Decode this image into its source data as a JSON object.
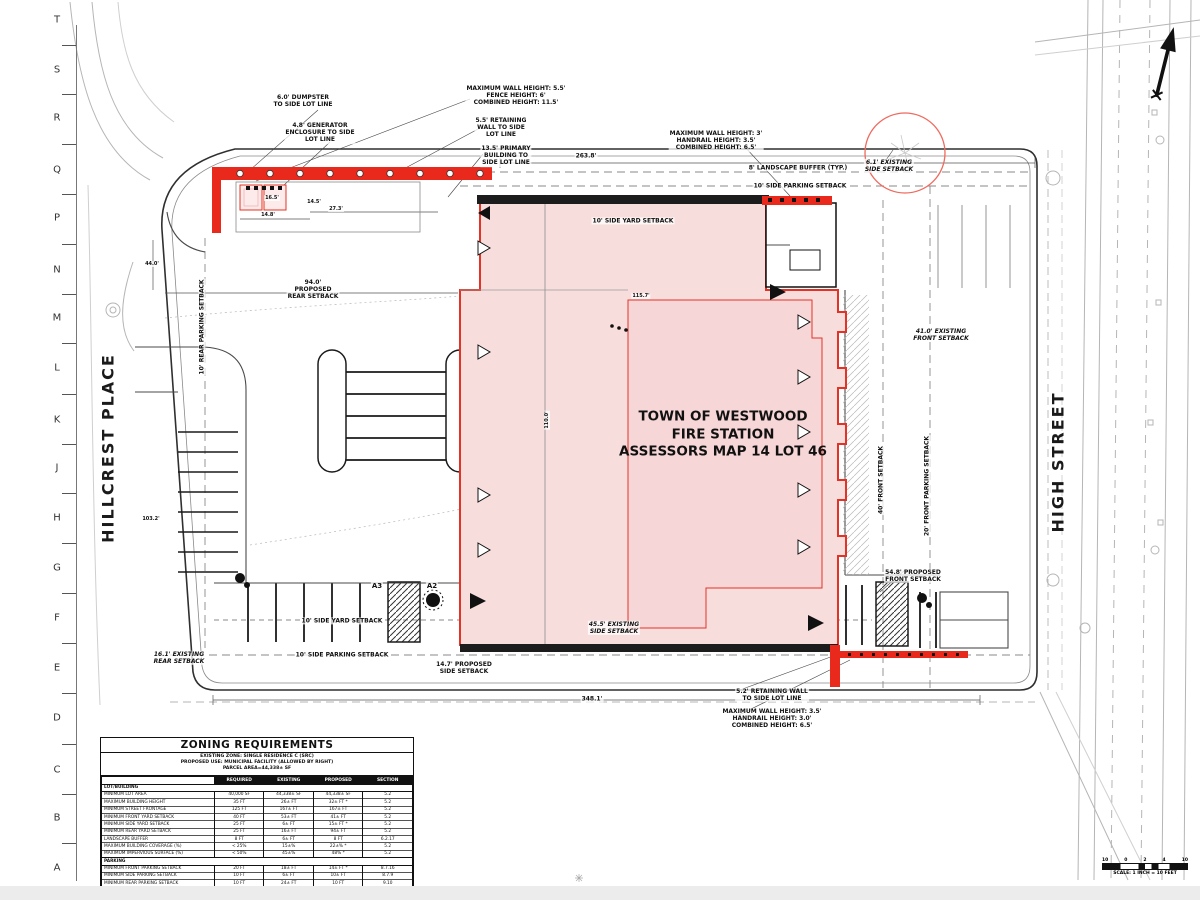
{
  "colors": {
    "accent_red": "#e43326",
    "pink_fill": "#f8dddd",
    "wall_black": "#1c1c1c"
  },
  "ruler": {
    "letters": [
      "T",
      "S",
      "R",
      "Q",
      "P",
      "N",
      "M",
      "L",
      "K",
      "J",
      "H",
      "G",
      "F",
      "E",
      "D",
      "C",
      "B",
      "A"
    ]
  },
  "streets": {
    "left": "HILLCREST PLACE",
    "right": "HIGH STREET"
  },
  "building": {
    "line1": "TOWN OF WESTWOOD",
    "line2": "FIRE STATION",
    "line3": "ASSESSORS MAP 14 LOT 46"
  },
  "annotations": [
    {
      "t": "6.0' DUMPSTER\nTO SIDE LOT LINE",
      "x": 303,
      "y": 101
    },
    {
      "t": "4.8' GENERATOR\nENCLOSURE TO SIDE\nLOT LINE",
      "x": 320,
      "y": 133
    },
    {
      "t": "MAXIMUM WALL HEIGHT: 5.5'\nFENCE HEIGHT: 6'\nCOMBINED HEIGHT: 11.5'",
      "x": 516,
      "y": 96
    },
    {
      "t": "5.5' RETAINING\nWALL TO SIDE\nLOT LINE",
      "x": 501,
      "y": 128
    },
    {
      "t": "13.5' PRIMARY\nBUILDING TO\nSIDE LOT LINE",
      "x": 506,
      "y": 156
    },
    {
      "t": "263.8'",
      "x": 586,
      "y": 156
    },
    {
      "t": "MAXIMUM WALL HEIGHT: 3'\nHANDRAIL HEIGHT: 3.5'\nCOMBINED HEIGHT: 6.5'",
      "x": 716,
      "y": 141
    },
    {
      "t": "8' LANDSCAPE BUFFER (TYP.)",
      "x": 798,
      "y": 168
    },
    {
      "t": "10' SIDE PARKING SETBACK",
      "x": 800,
      "y": 186
    },
    {
      "t": "6.1' EXISTING\nSIDE SETBACK",
      "x": 889,
      "y": 166,
      "i": true
    },
    {
      "t": "10' SIDE YARD SETBACK",
      "x": 633,
      "y": 221
    },
    {
      "t": "16.5'",
      "x": 272,
      "y": 198,
      "s": 5
    },
    {
      "t": "14.5'",
      "x": 314,
      "y": 202,
      "s": 5
    },
    {
      "t": "27.3'",
      "x": 336,
      "y": 209,
      "s": 5
    },
    {
      "t": "14.8'",
      "x": 268,
      "y": 215,
      "s": 5
    },
    {
      "t": "44.0'",
      "x": 152,
      "y": 264,
      "s": 5
    },
    {
      "t": "94.0'\nPROPOSED\nREAR SETBACK",
      "x": 313,
      "y": 290
    },
    {
      "t": "10' REAR PARKING SETBACK",
      "x": 202,
      "y": 327,
      "r": true
    },
    {
      "t": "115.7'",
      "x": 641,
      "y": 296,
      "s": 5
    },
    {
      "t": "110.0'",
      "x": 547,
      "y": 420,
      "r": true,
      "s": 5
    },
    {
      "t": "103.2'",
      "x": 151,
      "y": 519,
      "s": 5
    },
    {
      "t": "40' FRONT SETBACK",
      "x": 881,
      "y": 480,
      "r": true
    },
    {
      "t": "20' FRONT PARKING SETBACK",
      "x": 927,
      "y": 486,
      "r": true
    },
    {
      "t": "41.0' EXISTING\nFRONT SETBACK",
      "x": 941,
      "y": 335,
      "i": true
    },
    {
      "t": "A3",
      "x": 377,
      "y": 586,
      "s": 7
    },
    {
      "t": "A2",
      "x": 432,
      "y": 586,
      "s": 7
    },
    {
      "t": "10' SIDE YARD SETBACK",
      "x": 342,
      "y": 621
    },
    {
      "t": "45.5' EXISTING\nSIDE SETBACK",
      "x": 614,
      "y": 628,
      "i": true
    },
    {
      "t": "10' SIDE PARKING SETBACK",
      "x": 342,
      "y": 655
    },
    {
      "t": "16.1' EXISTING\nREAR SETBACK",
      "x": 179,
      "y": 658,
      "i": true
    },
    {
      "t": "14.7' PROPOSED\nSIDE SETBACK",
      "x": 464,
      "y": 668
    },
    {
      "t": "348.1'",
      "x": 592,
      "y": 699
    },
    {
      "t": "54.8' PROPOSED\nFRONT SETBACK",
      "x": 913,
      "y": 576
    },
    {
      "t": "5.2' RETAINING WALL\nTO SIDE LOT LINE",
      "x": 772,
      "y": 695
    },
    {
      "t": "MAXIMUM WALL HEIGHT: 3.5'\nHANDRAIL HEIGHT: 3.0'\nCOMBINED HEIGHT: 6.5'",
      "x": 772,
      "y": 719
    }
  ],
  "zoning_table": {
    "title": "ZONING REQUIREMENTS",
    "subtitle_lines": [
      "EXISTING ZONE: SINGLE RESIDENCE C (SRC)",
      "PROPOSED USE: MUNICIPAL FACILITY (ALLOWED BY RIGHT)",
      "PARCEL AREA=44,338± SF"
    ],
    "columns": [
      "",
      "REQUIRED",
      "EXISTING",
      "PROPOSED",
      "SECTION"
    ],
    "sections": [
      {
        "header": "LOT/BUILDING",
        "rows": [
          [
            "MINIMUM LOT AREA",
            "40,000 SF",
            "44,338± SF",
            "44,338± SF",
            "5.2"
          ],
          [
            "MAXIMUM BUILDING HEIGHT",
            "35 FT",
            "26± FT",
            "32± FT *",
            "5.2"
          ],
          [
            "MINIMUM STREET FRONTAGE",
            "125 FT",
            "167± FT",
            "167± FT",
            "5.2"
          ],
          [
            "MINIMUM FRONT YARD SETBACK",
            "40 FT",
            "53± FT",
            "41± FT",
            "5.2"
          ],
          [
            "MINIMUM SIDE YARD SETBACK",
            "25 FT",
            "6± FT",
            "15± FT *",
            "5.2"
          ],
          [
            "MINIMUM REAR YARD SETBACK",
            "25 FT",
            "16± FT",
            "94± FT",
            "5.2"
          ],
          [
            "LANDSCAPE BUFFER",
            "8 FT",
            "6± FT",
            "8 FT",
            "6.2.17"
          ],
          [
            "MAXIMUM BUILDING COVERAGE (%)",
            "< 25%",
            "15±%",
            "22±% *",
            "5.2"
          ],
          [
            "MAXIMUM IMPERVIOUS SURFACE (%)",
            "< 50%",
            "45±%",
            "48% *",
            "5.2"
          ]
        ]
      },
      {
        "header": "PARKING",
        "rows": [
          [
            "MINIMUM FRONT PARKING SETBACK",
            "20 FT",
            "18± FT",
            "14± FT *",
            "8.7.16"
          ],
          [
            "MINIMUM SIDE PARKING SETBACK",
            "10 FT",
            "6± FT",
            "10± FT",
            "8.7.9"
          ],
          [
            "MINIMUM REAR PARKING SETBACK",
            "10 FT",
            "24± FT",
            "10 FT",
            "9.10"
          ],
          [
            "MUNICIPAL FACILITIES",
            "N/A",
            "17",
            "38",
            "8.1.5.8"
          ],
          [
            "ADA STANDARD SPACES\nSTAFF LOT 1-25 SPACES\nPUBLIC LOT 1-25 SPACES",
            "1 SPACE",
            "0 SPACES",
            "2 SPACES",
            "ADA STANDARDS CHAPTER 5"
          ]
        ]
      }
    ],
    "footnote": "* ZONING RELIEF REQUIRED"
  },
  "scale_bar": {
    "ticks": [
      "10",
      "0",
      "2",
      "4",
      "10"
    ],
    "label": "SCALE: 1 INCH = 10 FEET"
  }
}
